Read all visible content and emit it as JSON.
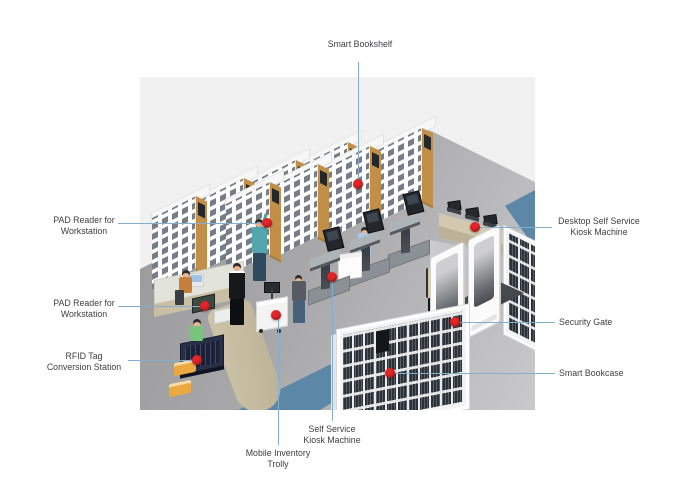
{
  "callouts": [
    {
      "id": "smart-bookshelf",
      "text": "Smart Bookshelf"
    },
    {
      "id": "pad-reader-workstation-1",
      "text": "PAD Reader for\nWorkstation"
    },
    {
      "id": "pad-reader-workstation-2",
      "text": "PAD Reader for\nWorkstation"
    },
    {
      "id": "rfid-tag-conversion-station",
      "text": "RFID Tag\nConversion Station"
    },
    {
      "id": "desktop-self-service-kiosk-machine",
      "text": "Desktop Self Service\nKiosk Machine"
    },
    {
      "id": "security-gate",
      "text": "Security Gate"
    },
    {
      "id": "smart-bookcase",
      "text": "Smart Bookcase"
    },
    {
      "id": "self-service-kiosk-machine",
      "text": "Self Service\nKiosk Machine"
    },
    {
      "id": "mobile-inventory-trolly",
      "text": "Mobile Inventory\nTrolly"
    }
  ],
  "colors": {
    "accent_red": "#e42528",
    "leader_blue": "#84aecd",
    "label_text": "#3f4042",
    "panel_gray": "#f1f1f2",
    "walkway_blue": "#5d87a7",
    "shelf_wood": "#c18f47",
    "desk_tan": "#d2c9ae",
    "mat_dark": "#3c4043",
    "gate_white": "#fbfbfc"
  }
}
